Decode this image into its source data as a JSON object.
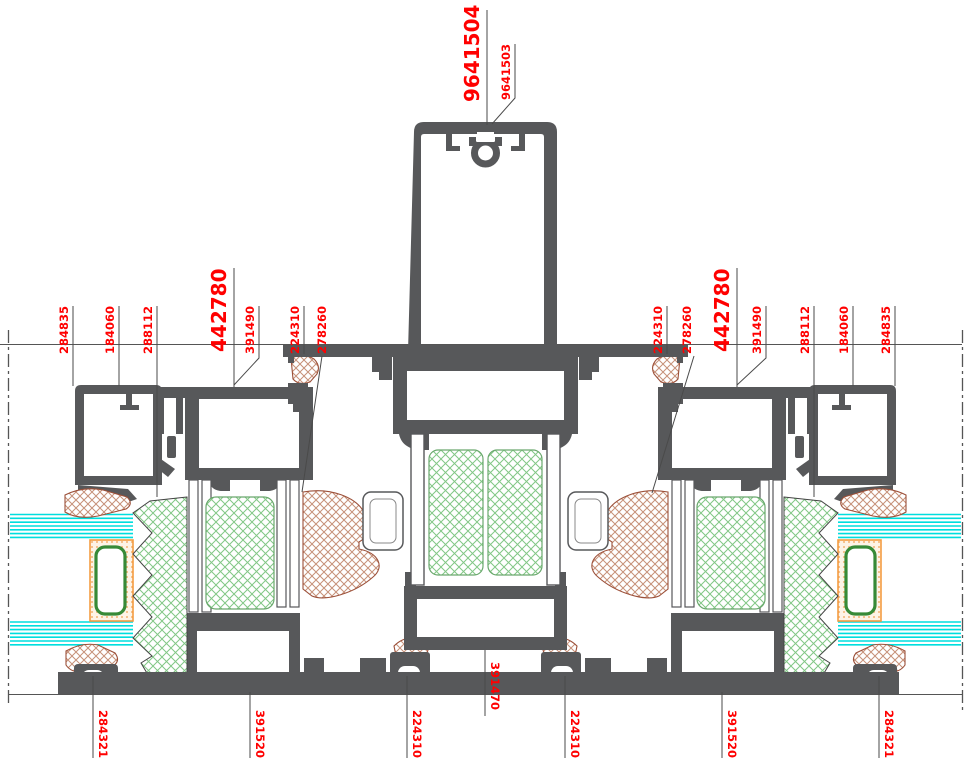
{
  "drawing": {
    "title": "aluminium-sliding-door-horizontal-section",
    "labels": {
      "top_main": "9641504",
      "top_sub": "9641503",
      "left": [
        "284835",
        "184060",
        "288112",
        "442780",
        "391490",
        "224310",
        "278260"
      ],
      "right": [
        "224310",
        "278260",
        "442780",
        "391490",
        "288112",
        "184060",
        "284835"
      ],
      "bottom": [
        "284321",
        "391520",
        "224310",
        "391470",
        "224310",
        "391520",
        "284321"
      ]
    },
    "colors": {
      "label_red": "#ff0000",
      "profile_gray": "#57585a",
      "glass_cyan": "#00dede",
      "gasket_brown": "#9c5039",
      "insulation_green": "#7cc47c",
      "spacer_orange": "#f49c42"
    }
  }
}
